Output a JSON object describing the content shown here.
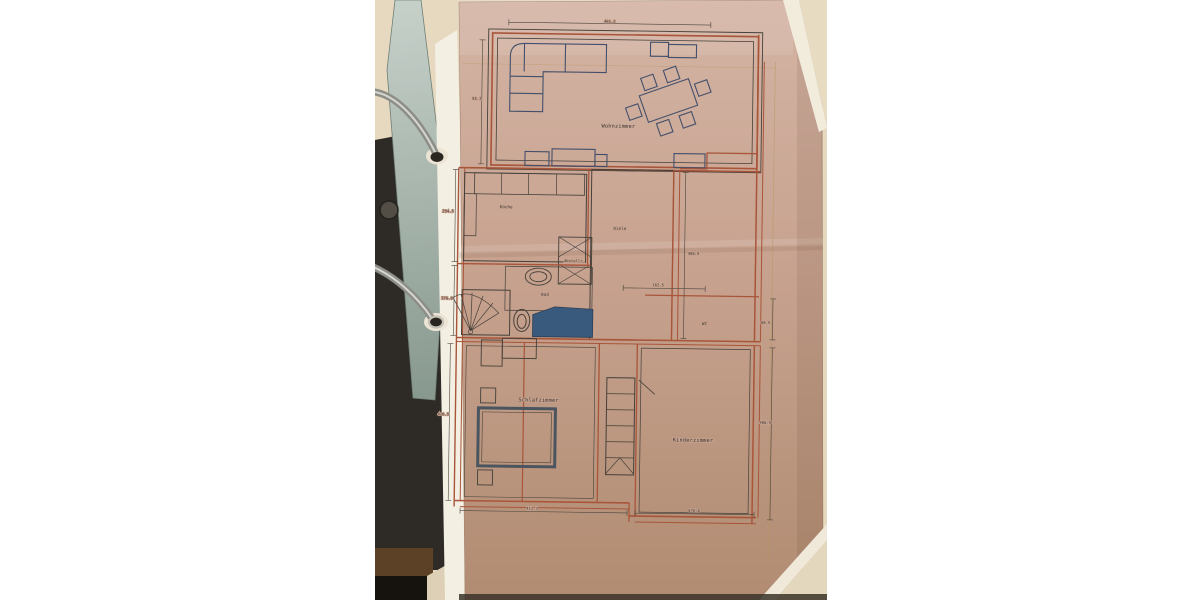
{
  "plan": {
    "rooms": {
      "wohnzimmer": "Wohnzimmer",
      "kueche": "Küche",
      "diele": "Diele",
      "abstell": "Abstellr.",
      "bad": "Bad",
      "wc": "WC",
      "schlafzimmer": "Schlafzimmer",
      "kinderzimmer": "Kinderzimmer"
    },
    "dimensions": {
      "top": "461.2",
      "left_upper": "95.1",
      "left_kueche": "254.5",
      "left_bad": "376.8",
      "left_schlafzimmer": "420.5",
      "right_diele": "486.5",
      "wc_width": "162.5",
      "wc_height": "86.5",
      "right_kinderzimmer": "406.5",
      "bottom_left": "413.3",
      "bottom_right": "876.8"
    }
  },
  "colors": {
    "wall-red": "#a8553a",
    "line-dark": "#45403a",
    "furniture-navy": "#44506b",
    "tub-blue": "#3a5a7d",
    "binder-cream": "#e6d9c0",
    "page-white": "#f4efe3",
    "paper-pink-top": "#d4b4a4",
    "paper-pink-mid": "#c7a28f",
    "paper-pink-bottom": "#b18c72",
    "metal-gray": "#a9a9a3",
    "hardware-dark": "#2e2b26"
  }
}
